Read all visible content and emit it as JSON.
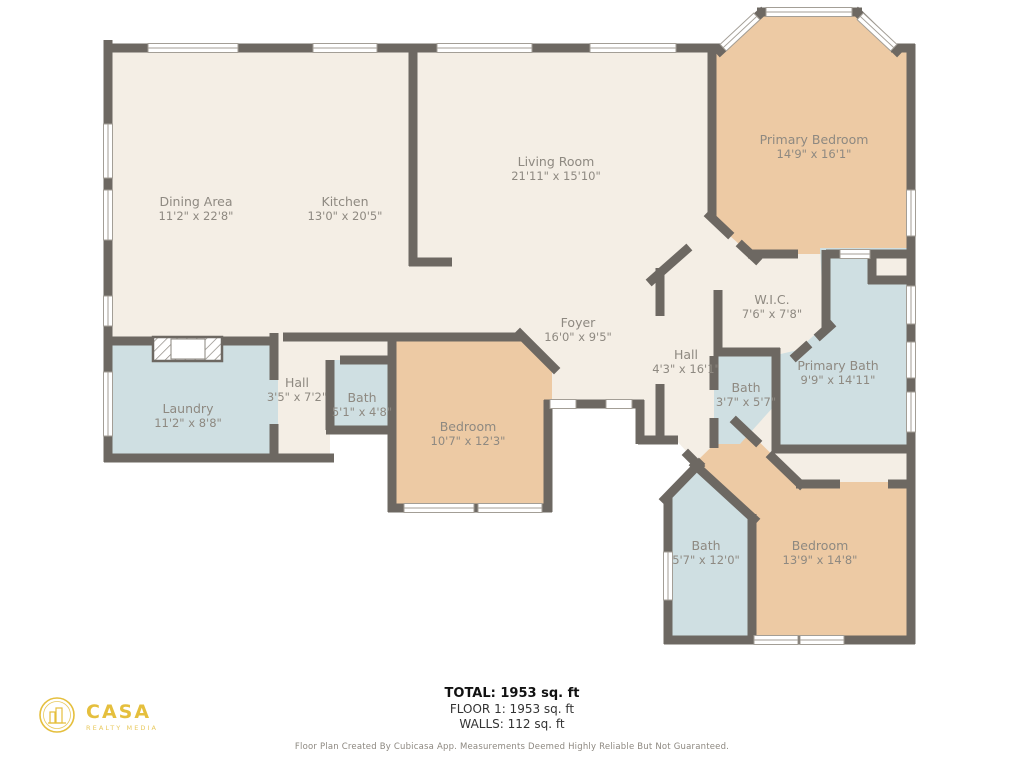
{
  "floorplan": {
    "rooms": [
      {
        "id": "dining",
        "name": "Dining Area",
        "dims": "11'2\" x 22'8\""
      },
      {
        "id": "kitchen",
        "name": "Kitchen",
        "dims": "13'0\" x 20'5\""
      },
      {
        "id": "living",
        "name": "Living Room",
        "dims": "21'11\" x 15'10\""
      },
      {
        "id": "primary-bedroom",
        "name": "Primary Bedroom",
        "dims": "14'9\" x 16'1\""
      },
      {
        "id": "wic",
        "name": "W.I.C.",
        "dims": "7'6\" x 7'8\""
      },
      {
        "id": "primary-bath",
        "name": "Primary Bath",
        "dims": "9'9\" x 14'11\""
      },
      {
        "id": "hall-main",
        "name": "Hall",
        "dims": "4'3\" x 16'1\""
      },
      {
        "id": "bath-main",
        "name": "Bath",
        "dims": "3'7\" x 5'7\""
      },
      {
        "id": "foyer",
        "name": "Foyer",
        "dims": "16'0\" x 9'5\""
      },
      {
        "id": "bedroom-front",
        "name": "Bedroom",
        "dims": "10'7\" x 12'3\""
      },
      {
        "id": "bath-front",
        "name": "Bath",
        "dims": "5'1\" x 4'8\""
      },
      {
        "id": "hall-small",
        "name": "Hall",
        "dims": "3'5\" x 7'2\""
      },
      {
        "id": "laundry",
        "name": "Laundry",
        "dims": "11'2\" x 8'8\""
      },
      {
        "id": "bath-back",
        "name": "Bath",
        "dims": "5'7\" x 12'0\""
      },
      {
        "id": "bedroom-back",
        "name": "Bedroom",
        "dims": "13'9\" x 14'8\""
      }
    ],
    "colors": {
      "wall": "#6d6862",
      "common": "#f4eee5",
      "bedroom": "#edcaa4",
      "bath": "#cfdfe2",
      "window_frame": "#a39e96",
      "label_text": "#8e8981"
    }
  },
  "summary": {
    "total": "TOTAL: 1953 sq. ft",
    "floor": "FLOOR 1: 1953 sq. ft",
    "walls": "WALLS: 112 sq. ft"
  },
  "footer": {
    "disclaimer": "Floor Plan Created By Cubicasa App. Measurements Deemed Highly Reliable But Not Guaranteed."
  },
  "logo": {
    "brand": "CASA",
    "tagline": "REALTY MEDIA"
  }
}
